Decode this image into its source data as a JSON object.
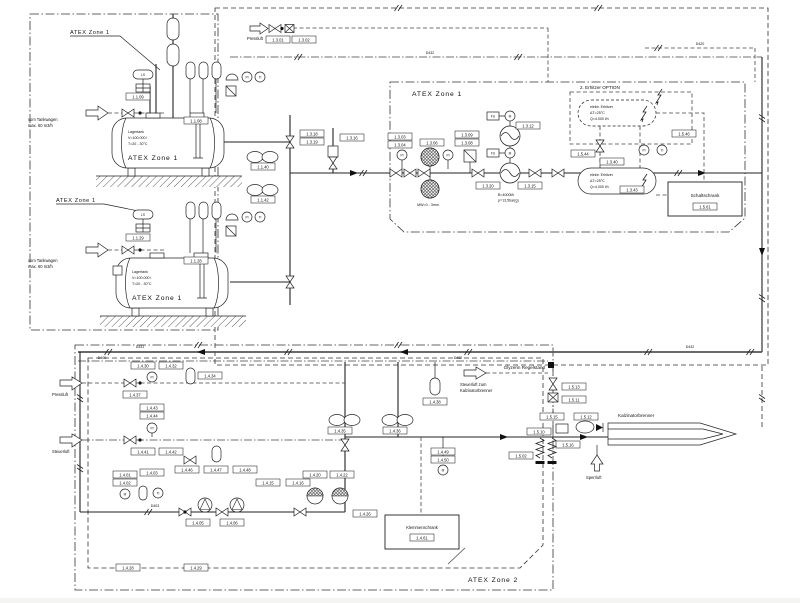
{
  "d": {
    "zones": {
      "z1a": "ATEX Zone 1",
      "z1b": "ATEX Zone 1",
      "z1c": "ATEX Zone 1",
      "z2": "ATEX Zone 2"
    },
    "tank": {
      "l1": "Lagertank",
      "l2": "V=100.000 l",
      "l3": "T=20 - 30°C",
      "zone": "ATEX Zone 1"
    },
    "labels": {
      "tw1": "vom Tankwagen",
      "tw2": "max. 60 m3/h",
      "pressluft": "Pressluft",
      "steuerluft": "Steuerluft",
      "sperrluft": "Sperrluft",
      "st_zum1": "Steuerluft zum",
      "st_zum2": "Kalzinatorbrenner",
      "glyzerin": "Glyzerin Regelstand",
      "brenner": "Kalzinatorbrenner",
      "erhitzer_opt": "2. Erhitzer OPTION",
      "heater1": "elektr. Erhitzer",
      "heater2": "ΔT=25°C",
      "heater3": "Q=4.000 l/h",
      "schaltschrank": "Schaltschrank",
      "klemmenschrank": "Klemmenschrank",
      "mesh": "MW=0 - 3mm",
      "flow1": "B=4000l/h",
      "flow2": "p=13,5bar(g)"
    },
    "lines": {
      "d432": "D432",
      "d420": "D420",
      "d431": "D431",
      "d432b": "D432",
      "d400": "D400",
      "d402": "D402",
      "d403": "D403"
    },
    "instr": {
      "pi": "PI",
      "ti": "TI",
      "m": "M",
      "fu": "FU",
      "ls": "LS"
    },
    "tags": {
      "pl1": "1.3.01",
      "pl2": "1.3.02",
      "tk1a": "1.1.09",
      "tk1b": "1.1.08",
      "tk2a": "1.1.29",
      "tk2b": "1.1.28",
      "col1": "1.1.40",
      "col2": "1.1.42",
      "cs1": "1.3.18",
      "cs2": "1.3.19",
      "cs3": "1.3.16",
      "mz1": "1.3.03",
      "mz2": "1.3.04",
      "mz3": "1.3.06",
      "mz4": "1.3.08",
      "mz5": "1.3.09",
      "hx1": "1.3.12",
      "hx2": "1.3.15",
      "hx3": "1.3.20",
      "ht1": "1.5.44",
      "ht2": "1.3.40",
      "ht3": "1.5.46",
      "ht4": "1.3.43",
      "ss": "1.5.61",
      "b01": "1.4.30",
      "b02": "1.4.32",
      "b03": "1.4.34",
      "b04": "1.4.37",
      "b05": "1.4.43",
      "b06": "1.4.44",
      "b07": "1.4.41",
      "b08": "1.4.42",
      "b09": "1.4.46",
      "b10": "1.4.47",
      "b11": "1.4.48",
      "b12": "1.4.35",
      "b13": "1.4.36",
      "b14": "1.4.38",
      "b15": "1.4.01",
      "b16": "1.4.02",
      "b17": "1.4.03",
      "b18": "1.4.05",
      "b19": "1.4.06",
      "b20": "1.4.15",
      "b21": "1.4.16",
      "b22": "1.4.20",
      "b23": "1.4.22",
      "b24": "1.4.26",
      "b25": "1.4.49",
      "b26": "1.4.50",
      "ks": "1.4.61",
      "br1": "1.5.13",
      "br2": "1.5.11",
      "br3": "1.5.15",
      "br4": "1.5.12",
      "br5": "1.5.10",
      "br6": "1.5.16",
      "br7": "1.5.02",
      "bl1": "1.4.28",
      "bl2": "1.4.29"
    }
  }
}
